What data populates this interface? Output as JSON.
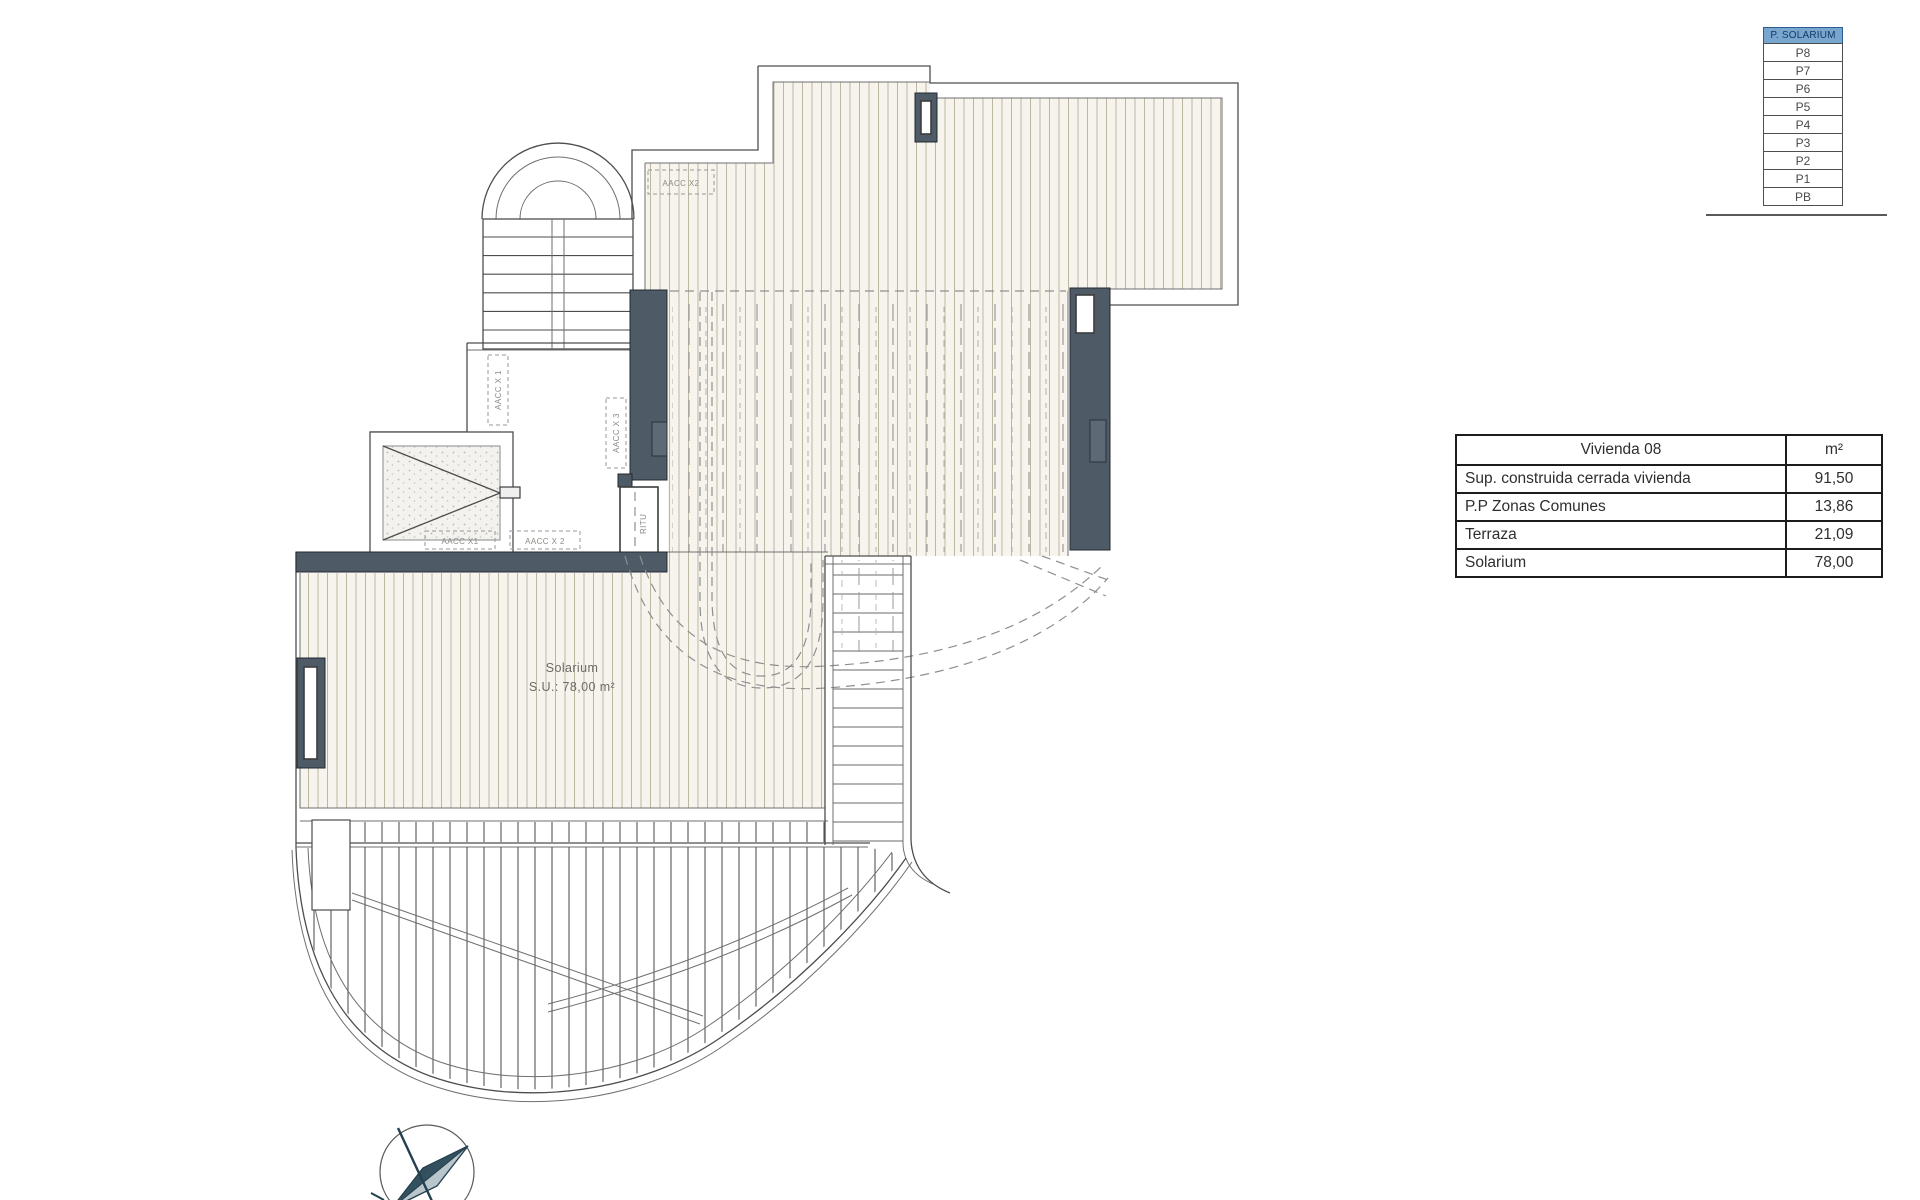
{
  "level_indicator": {
    "levels": [
      {
        "label": "P. SOLARIUM",
        "active": true
      },
      {
        "label": "P8",
        "active": false
      },
      {
        "label": "P7",
        "active": false
      },
      {
        "label": "P6",
        "active": false
      },
      {
        "label": "P5",
        "active": false
      },
      {
        "label": "P4",
        "active": false
      },
      {
        "label": "P3",
        "active": false
      },
      {
        "label": "P2",
        "active": false
      },
      {
        "label": "P1",
        "active": false
      },
      {
        "label": "PB",
        "active": false
      }
    ],
    "highlight_color": "#79a6cf"
  },
  "area_table": {
    "title": "Vivienda 08",
    "unit": "m²",
    "rows": [
      {
        "label": "Sup. construida cerrada vivienda",
        "value": "91,50"
      },
      {
        "label": "P.P Zonas Comunes",
        "value": "13,86"
      },
      {
        "label": "Terraza",
        "value": "21,09"
      },
      {
        "label": "Solarium",
        "value": "78,00"
      }
    ]
  },
  "plan": {
    "solarium_name": "Solarium",
    "solarium_area": "S.U.: 78,00 m²",
    "labels": {
      "aacc_x2_top": "AACC X2",
      "aacc_x1_vertical": "AACC X 1",
      "aacc_x1": "AACC X1",
      "aacc_x2": "AACC X 2",
      "aacc_x3_vertical": "AACC X 3",
      "ritu": "RITU"
    },
    "colors": {
      "wall": "#4e5a66",
      "deck_fill": "#f7f4ed",
      "deck_line": "#bdb6a3",
      "line": "#4d4d4d"
    }
  }
}
